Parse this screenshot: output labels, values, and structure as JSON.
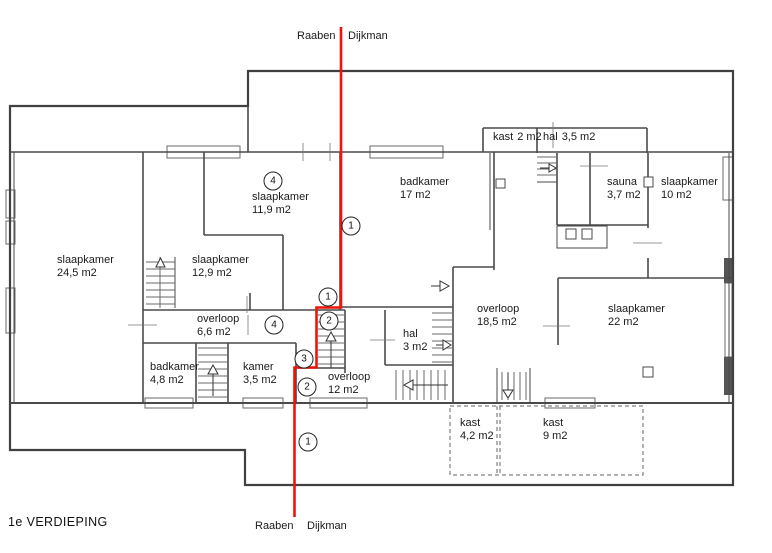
{
  "title": "1e VERDIEPING",
  "boundary": {
    "top": {
      "left": "Raaben",
      "right": "Dijkman"
    },
    "bottom": {
      "left": "Raaben",
      "right": "Dijkman"
    }
  },
  "colors": {
    "boundary_line": "#ee1409",
    "walls": "#4a4a4a",
    "text": "#1a1a1a"
  },
  "rooms": [
    {
      "name": "slaapkamer",
      "area": "24,5 m2"
    },
    {
      "name": "slaapkamer",
      "area": "12,9 m2"
    },
    {
      "name": "slaapkamer",
      "area": "11,9 m2"
    },
    {
      "name": "badkamer",
      "area": "17 m2"
    },
    {
      "name": "kast",
      "area": "2 m2"
    },
    {
      "name": "hal",
      "area": "3,5 m2"
    },
    {
      "name": "sauna",
      "area": "3,7 m2"
    },
    {
      "name": "slaapkamer",
      "area": "10 m2"
    },
    {
      "name": "overloop",
      "area": "6,6 m2"
    },
    {
      "name": "overloop",
      "area": "18,5 m2"
    },
    {
      "name": "slaapkamer",
      "area": "22 m2"
    },
    {
      "name": "hal",
      "area": "3 m2"
    },
    {
      "name": "badkamer",
      "area": "4,8 m2"
    },
    {
      "name": "kamer",
      "area": "3,5 m2"
    },
    {
      "name": "overloop",
      "area": "12 m2"
    },
    {
      "name": "kast",
      "area": "4,2 m2"
    },
    {
      "name": "kast",
      "area": "9 m2"
    }
  ],
  "markers": [
    {
      "num": "4"
    },
    {
      "num": "1"
    },
    {
      "num": "1"
    },
    {
      "num": "2"
    },
    {
      "num": "4"
    },
    {
      "num": "3"
    },
    {
      "num": "2"
    },
    {
      "num": "1"
    }
  ]
}
